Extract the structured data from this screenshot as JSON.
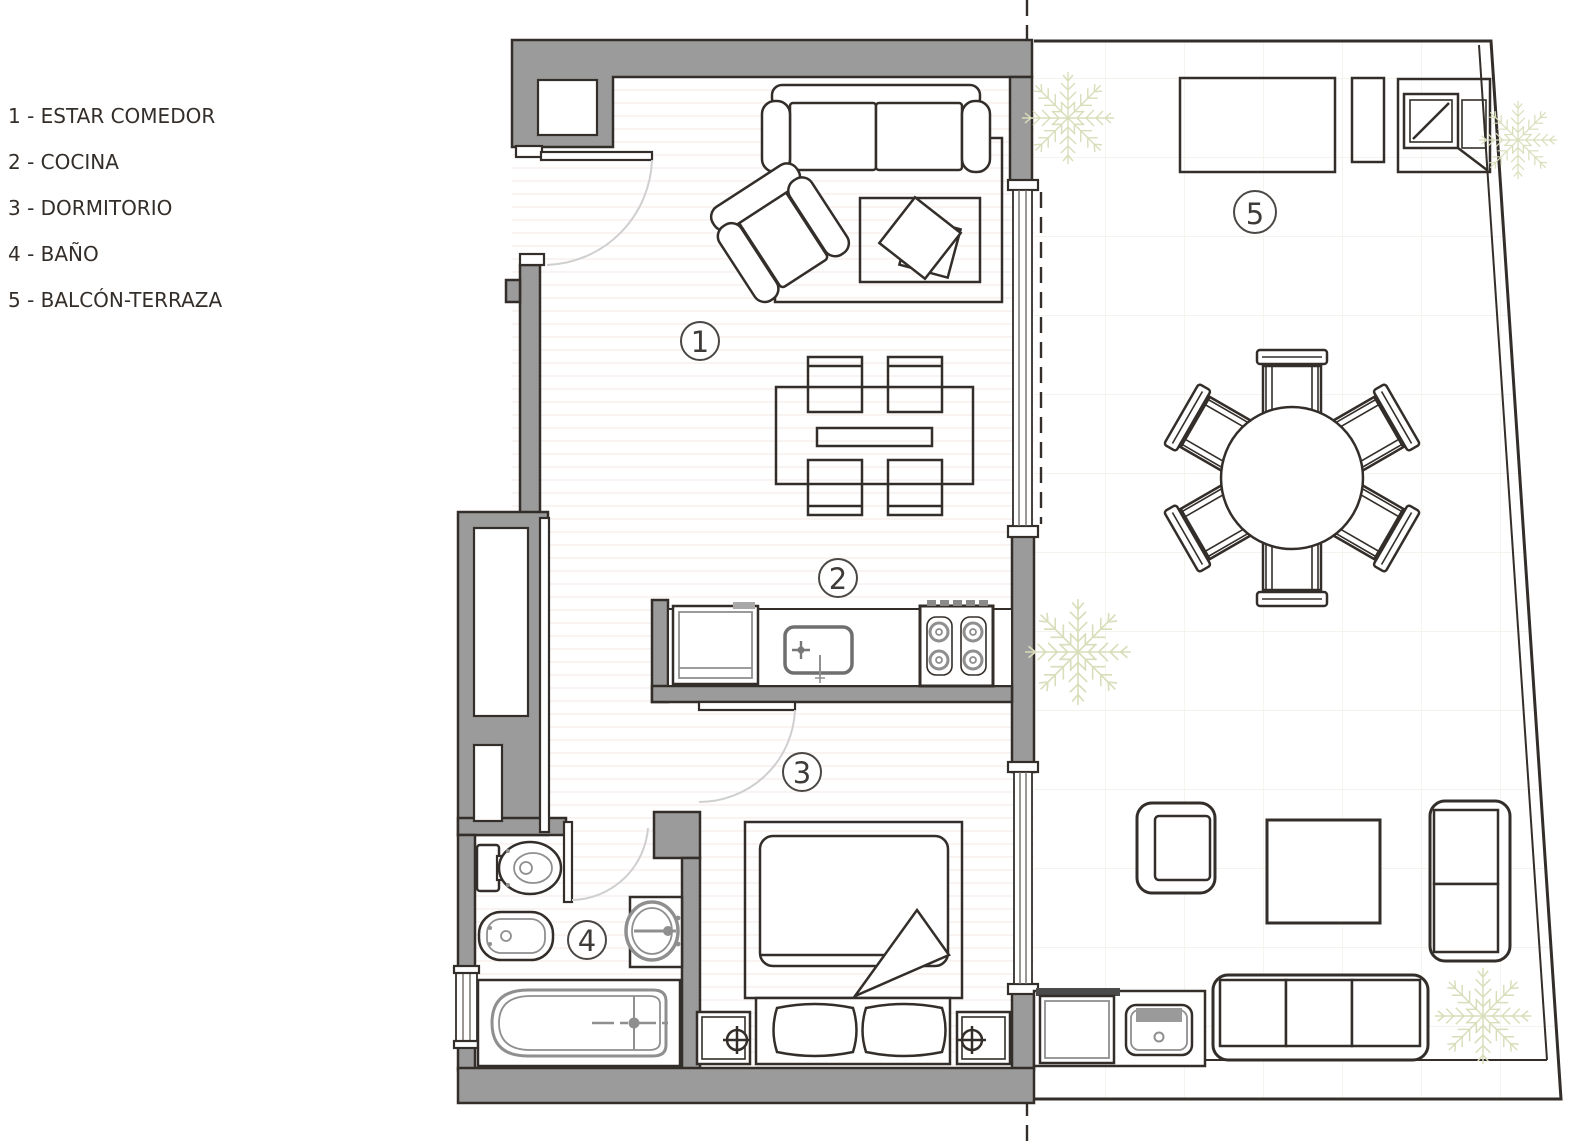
{
  "legend": {
    "items": [
      {
        "text": "1 - ESTAR COMEDOR"
      },
      {
        "text": "2 - COCINA"
      },
      {
        "text": "3 - DORMITORIO"
      },
      {
        "text": "4 - BAÑO"
      },
      {
        "text": "5 - BALCÓN-TERRAZA"
      }
    ]
  },
  "room_labels": {
    "estar_comedor": "1",
    "cocina": "2",
    "dormitorio": "3",
    "bano": "4",
    "balcon_terraza": "5"
  },
  "colors": {
    "wall_gray": "#9b9b9b",
    "line_dark": "#332e2a",
    "fixture_gray": "#8f8f8f",
    "plant_green": "#d9deba",
    "door_arc": "#cfcfcf",
    "floor_stripe": "#f6efec",
    "tile_line": "#f1f1e8",
    "label_ink": "#3f3b38"
  }
}
